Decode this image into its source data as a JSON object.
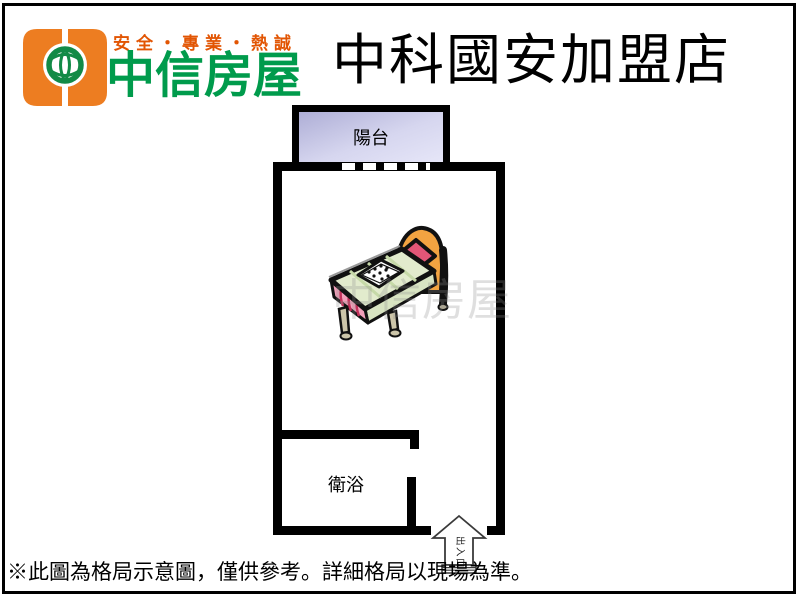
{
  "header": {
    "slogan": "安全・專業・熱誠",
    "brand_name": "中信房屋",
    "store_title": "中科國安加盟店"
  },
  "floorplan": {
    "balcony_label": "陽台",
    "bathroom_label": "衛浴",
    "entrance_label": "出入口",
    "watermark": "中信房屋"
  },
  "footer": {
    "disclaimer": "※此圖為格局示意圖，僅供參考。詳細格局以現場為準。"
  },
  "colors": {
    "brand_orange": "#ED7D21",
    "brand_green": "#009B4C",
    "slogan_orange": "#E25503",
    "wall_black": "#000000",
    "balcony_fill_top": "#AEAED6",
    "balcony_fill_bottom": "#E6E6F8",
    "bed_headboard_orange": "#F2A341",
    "bed_pillow_pink": "#E25677",
    "bed_sheet_green": "#E2EBCD",
    "bed_sheet_side_green": "#D8E4C2",
    "bed_skirt_pink": "#F2A0BA",
    "bed_leg_tan": "#CCC5A9",
    "arrow_outline_gray": "#3A3A3A"
  }
}
